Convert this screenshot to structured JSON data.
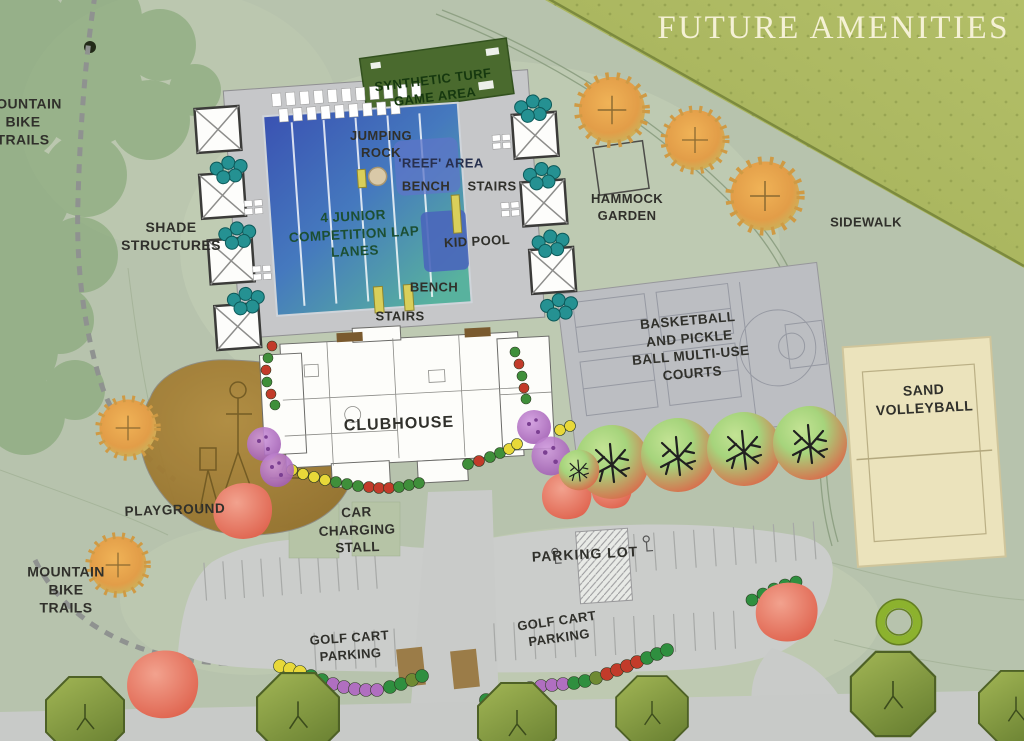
{
  "title": "FUTURE AMENITIES",
  "labels": {
    "mountain_bike_trails_top": {
      "lines": [
        "MOUNTAIN",
        "BIKE",
        "TRAILS"
      ]
    },
    "shade_structures": {
      "lines": [
        "SHADE",
        "STRUCTURES"
      ]
    },
    "synthetic_turf_game_area": {
      "lines": [
        "SYNTHETIC TURF",
        "GAME AREA"
      ]
    },
    "jumping_rock": {
      "lines": [
        "JUMPING",
        "ROCK"
      ]
    },
    "reef_area": {
      "text": "'REEF' AREA"
    },
    "bench_upper": {
      "text": "BENCH"
    },
    "stairs_upper": {
      "text": "STAIRS"
    },
    "lap_lanes": {
      "lines": [
        "4 JUNIOR",
        "COMPETITION LAP",
        "LANES"
      ]
    },
    "kid_pool": {
      "text": "KID POOL"
    },
    "bench_lower": {
      "text": "BENCH"
    },
    "stairs_lower": {
      "text": "STAIRS"
    },
    "hammock_garden": {
      "lines": [
        "HAMMOCK",
        "GARDEN"
      ]
    },
    "sidewalk": {
      "text": "SIDEWALK"
    },
    "courts": {
      "lines": [
        "BASKETBALL",
        "AND PICKLE",
        "BALL MULTI-USE",
        "COURTS"
      ]
    },
    "sand_volleyball": {
      "lines": [
        "SAND",
        "VOLLEYBALL"
      ]
    },
    "clubhouse": {
      "text": "CLUBHOUSE"
    },
    "playground": {
      "text": "PLAYGROUND"
    },
    "mountain_bike_trails_bottom": {
      "lines": [
        "MOUNTAIN",
        "BIKE",
        "TRAILS"
      ]
    },
    "car_charging_stall": {
      "lines": [
        "CAR",
        "CHARGING",
        "STALL"
      ]
    },
    "parking_lot": {
      "text": "PARKING LOT"
    },
    "golf_cart_parking_left": {
      "lines": [
        "GOLF CART",
        "PARKING"
      ]
    },
    "golf_cart_parking_right": {
      "lines": [
        "GOLF CART",
        "PARKING"
      ]
    }
  },
  "palette": {
    "base_green": "#b7c3ad",
    "hillside_olive": "#a4b05a",
    "pool_deep": "#3a52b2",
    "pool_shallow": "#58b29e",
    "deck_gray": "#c6c7c9",
    "turf_green": "#4a6a2e",
    "court_gray": "#bcbec2",
    "sand_tan": "#ebe3bc",
    "playground_brown": "#a5802f",
    "parking_gray": "#cbcdcb",
    "title_cream": "#f5f1d5",
    "label_dark": "#30302b"
  },
  "map_features": [
    "lap-pool",
    "reef-area",
    "kid-pool",
    "synthetic-turf-game-area",
    "cabana-shade-structures",
    "lounge-chairs",
    "teal-shrubs",
    "clubhouse",
    "basketball-pickleball-courts",
    "sand-volleyball-court",
    "hammock-garden",
    "playground",
    "parking-lot",
    "accessible-parking",
    "car-charging-stall",
    "golf-cart-parking",
    "mountain-bike-trails",
    "sidewalk",
    "orange-trees",
    "red-green-trees",
    "purple-trees",
    "olive-octagon-trees",
    "shrub-beds"
  ]
}
